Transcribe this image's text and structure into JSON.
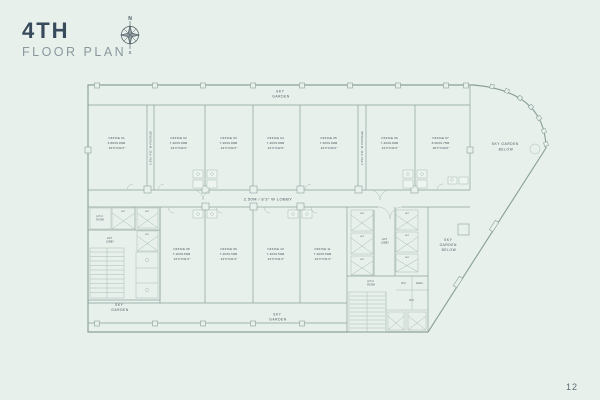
{
  "page": {
    "title": "4TH",
    "subtitle": "FLOOR PLAN",
    "page_number": "12",
    "compass": {
      "north": "N",
      "south": "S"
    }
  },
  "colors": {
    "background": "#e8f0ec",
    "plan_line": "#8aa09a",
    "title": "#374b5d",
    "subtitle": "#8a989e",
    "plan_text": "#47545a"
  },
  "plan": {
    "labels": {
      "sky": "SKY",
      "garden": "GARDEN",
      "below": "BELOW",
      "sky_garden": "SKY GARDEN",
      "lobby": "2.50M / 8'3\" W LOBBY",
      "passage": "1.5M / 4'11\" W PASSAGE"
    },
    "cores": {
      "ahu_l1": "A.H.U",
      "ahu_l2": "ROOM",
      "lift_lobby_l1": "LIFT",
      "lift_lobby_l2": "LOBBY",
      "lift": "LIFT",
      "wc": "W.C.",
      "elec": "ELEC."
    },
    "offices_top": [
      {
        "name": "OFFICE 01",
        "metric": "5.80X9.80M",
        "imperial": "19'0\"X32'2\""
      },
      {
        "name": "OFFICE 02",
        "metric": "7.40X9.80M",
        "imperial": "24'3\"X32'2\""
      },
      {
        "name": "OFFICE 03",
        "metric": "7.40X9.80M",
        "imperial": "24'3\"X32'2\""
      },
      {
        "name": "OFFICE 04",
        "metric": "7.40X9.80M",
        "imperial": "24'3\"X32'2\""
      },
      {
        "name": "OFFICE 05",
        "metric": "7.40X9.80M",
        "imperial": "24'3\"X32'2\""
      },
      {
        "name": "OFFICE 06",
        "metric": "7.40X9.80M",
        "imperial": "24'3\"X32'2\""
      },
      {
        "name": "OFFICE 07",
        "metric": "8.00X9.75M",
        "imperial": "26'3\"X32'0\""
      }
    ],
    "offices_bottom": [
      {
        "name": "OFFICE 08",
        "metric": "7.40X9.50M",
        "imperial": "24'3\"X31'2\""
      },
      {
        "name": "OFFICE 09",
        "metric": "7.40X9.50M",
        "imperial": "24'3\"X31'2\""
      },
      {
        "name": "OFFICE 10",
        "metric": "7.40X9.50M",
        "imperial": "24'3\"X31'2\""
      },
      {
        "name": "OFFICE 11",
        "metric": "7.40X9.50M",
        "imperial": "24'3\"X31'2\""
      }
    ]
  }
}
